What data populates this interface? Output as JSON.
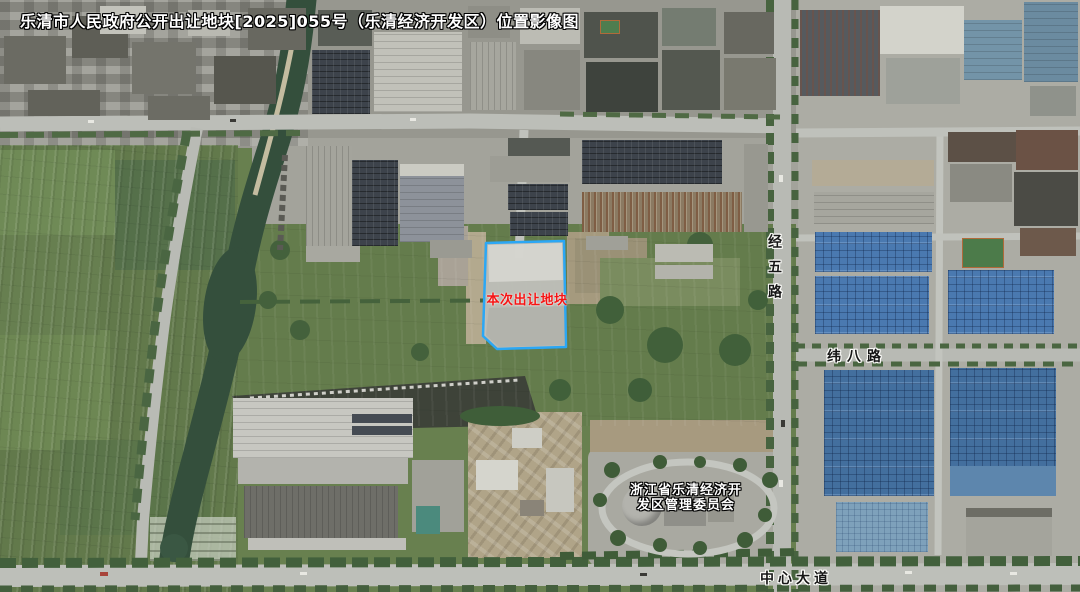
{
  "page": {
    "type": "satellite-location-image-map",
    "region": "乐清经济开发区"
  },
  "title": "乐清市人民政府公开出让地块[2025]055号（乐清经济开发区）位置影像图",
  "parcel": {
    "label": "本次出让地块",
    "border_color": "#2BA7F5",
    "label_color": "#F51414",
    "fill_description": "cleared grey land plot outlined in blue"
  },
  "labels": {
    "committee_line1": "浙江省乐清经济开",
    "committee_line2": "发区管理委员会"
  },
  "roads": {
    "jingwu": "经五路",
    "weiba": "纬八路",
    "zhongxin": "中心大道"
  },
  "colors": {
    "field_green": "#68804F",
    "river_green": "#344F3C",
    "road_grey": "#B9BBB5",
    "solar_roof_blue": "#4A79B0",
    "title_text": "#FFFFFF",
    "road_label_text": "#161616"
  }
}
